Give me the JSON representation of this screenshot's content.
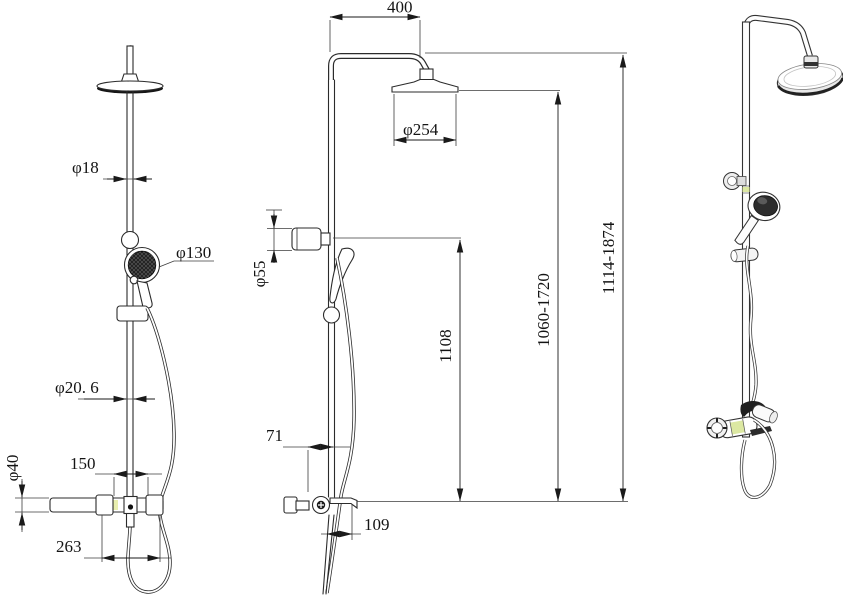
{
  "drawing": {
    "kind": "shower-column-technical-drawing",
    "colors": {
      "line": "#2b2b2b",
      "dim_line": "#3c3c3c",
      "accent": "#dce8a2",
      "dark_fill": "#1d1d1d",
      "background": "#ffffff"
    },
    "views": {
      "front": {
        "dims": {
          "pipe_top_diameter": "φ18",
          "hand_shower_diameter": "φ130",
          "pipe_diameter": "φ20. 6",
          "valve_spacing": "150",
          "bar_diameter": "φ40",
          "bar_span": "263"
        }
      },
      "side": {
        "dims": {
          "arm_reach": "400",
          "head_diameter": "φ254",
          "bracket_diameter": "φ55",
          "bracket_height": "1108",
          "head_height_range": "1060-1720",
          "overall_height_range": "1114-1874",
          "slider_offset": "71",
          "shelf_depth": "109"
        }
      }
    }
  }
}
